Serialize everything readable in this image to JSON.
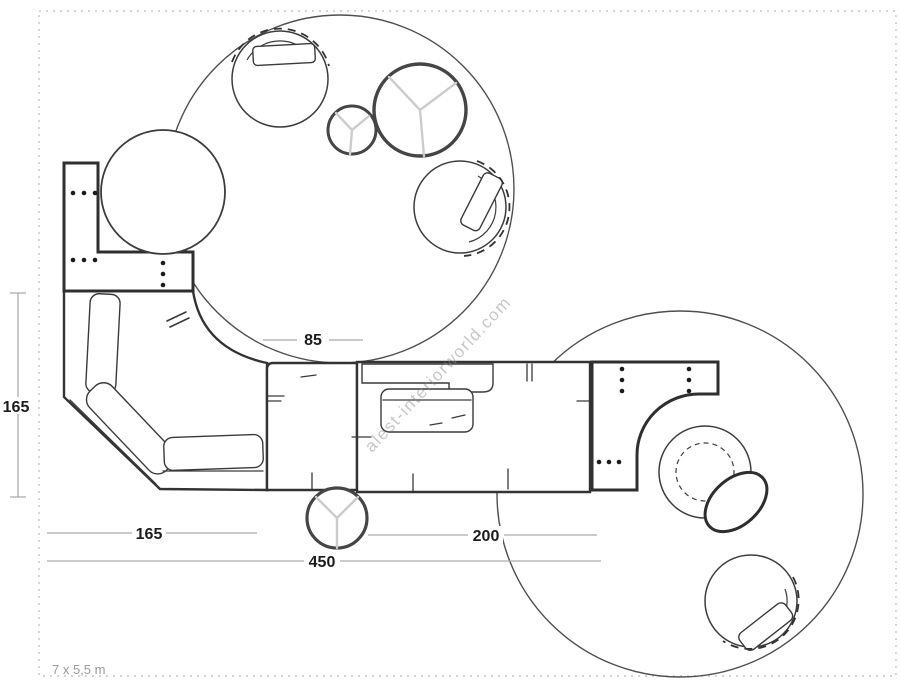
{
  "plan": {
    "type": "sectional-sofa floor plan, top view",
    "room_size_label": "7 x 5,5 m",
    "watermark": "alest-interiorworld.com"
  },
  "dimensions": {
    "left_height": "165",
    "center_module_width": "85",
    "left_chaise_width": "165",
    "right_module_width": "200",
    "total_width": "450"
  },
  "colors": {
    "background": "#ffffff",
    "sofa_outline": "#333333",
    "rug_outline": "#4f4f4f",
    "dimension_line": "#ababab",
    "dimension_text": "#1c1c1c",
    "room_text": "#9a9a9a",
    "watermark_text": "#8a8a8a",
    "table_legs": "#cccccc",
    "dashed_border": "#c6c6c6"
  }
}
